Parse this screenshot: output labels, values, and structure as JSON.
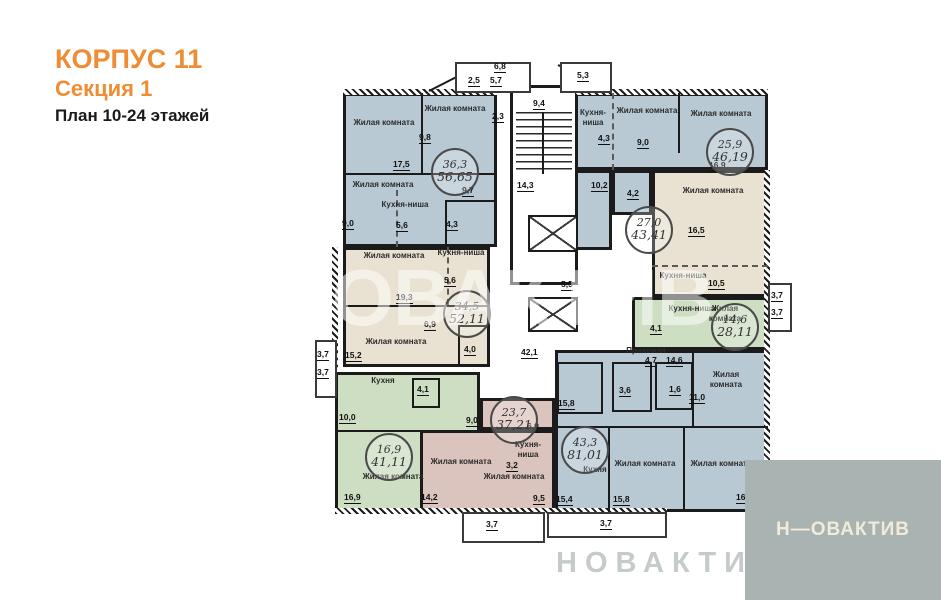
{
  "header": {
    "building": "КОРПУС 11",
    "section": "Секция 1",
    "plan": "План 10-24 этажей"
  },
  "watermark": {
    "main": "НОВАКТИВ",
    "bottom": "НОВАКТИВ"
  },
  "logo": {
    "text": "Н—ОВАКТИВ"
  },
  "colors": {
    "accent": "#ee8d33",
    "apartment_blue": "#b9c9d3",
    "apartment_beige": "#e9e2d2",
    "apartment_green": "#cddec3",
    "apartment_pink": "#dcc4be",
    "wall": "#1b1b1b",
    "logo_bg": "#a9b3b1"
  },
  "core": {
    "stairs_width": "9,4",
    "stairs_depth": "14,3",
    "lift_gap": "5,5",
    "corridor_area": "42,1"
  },
  "edges": {
    "top": [
      "6,8",
      "2,5",
      "5,7",
      "5,3"
    ],
    "left": [
      "3,7",
      "3,7"
    ],
    "right": [
      "3,7",
      "3,7"
    ],
    "bottom": [
      "3,7",
      "3,7"
    ]
  },
  "apartments": [
    {
      "living": "36,3",
      "total": "56,65",
      "rooms": [
        {
          "label": "Жилая комната",
          "area": "17,5"
        },
        {
          "label": "Жилая комната",
          "area": "9,8"
        },
        {
          "label": "Жилая комната",
          "area": "9,0"
        },
        {
          "label": "Кухня-ниша",
          "area": "5,6"
        }
      ],
      "dims": {
        "bath": "4,3",
        "hall": "9,7",
        "edge": "2,3"
      }
    },
    {
      "living": "34,5",
      "total": "52,11",
      "rooms": [
        {
          "label": "Жилая комната",
          "area": "19,3"
        },
        {
          "label": "Кухня-ниша",
          "area": "5,6"
        },
        {
          "label": "Жилая комната",
          "area": "15,2"
        }
      ],
      "dims": {
        "hall": "6,9",
        "bath": "4,0"
      }
    },
    {
      "living": "16,9",
      "total": "41,11",
      "rooms": [
        {
          "label": "Кухня",
          "area": "10,0"
        },
        {
          "label": "Жилая комната",
          "area": "16,9"
        }
      ],
      "dims": {
        "bath": "4,1",
        "hall": "9,0"
      }
    },
    {
      "living": "23,7",
      "total": "37,21",
      "rooms": [
        {
          "label": "Жилая комната",
          "area": "14,2"
        },
        {
          "label": "Жилая комната",
          "area": "9,5"
        },
        {
          "label": "Кухня-ниша",
          "area": "3,2"
        }
      ],
      "dims": {
        "top": "6,0"
      }
    },
    {
      "living": "43,3",
      "total": "81,01",
      "rooms": [
        {
          "label": "Кухня",
          "area": "15,4"
        },
        {
          "label": "Жилая комната",
          "area": "15,8"
        },
        {
          "label": "Жилая комната",
          "area": "16,5"
        },
        {
          "label": "Жилая комната",
          "area": "11,0"
        },
        {
          "label": "Прихожая",
          "area": "4,7"
        }
      ],
      "dims": {
        "entry": "15,8",
        "hall": "14,6",
        "bath": "3,6",
        "wc": "1,6"
      }
    },
    {
      "living": "14,6",
      "total": "28,11",
      "rooms": [
        {
          "label": "Кухня-ниша",
          "area": "4,1"
        },
        {
          "label": "Жилая комната"
        }
      ],
      "dims": {}
    },
    {
      "living": "27,0",
      "total": "43,41",
      "rooms": [
        {
          "label": "Жилая комната",
          "area": "16,5"
        },
        {
          "label": "Кухня-ниша",
          "area": "10,5"
        }
      ],
      "dims": {}
    },
    {
      "living": "25,9",
      "total": "46,19",
      "rooms": [
        {
          "label": "Жилая комната",
          "area": "9,0"
        },
        {
          "label": "Жилая комната",
          "area": "16,9"
        },
        {
          "label": "Кухня-ниша",
          "area": "4,3"
        }
      ],
      "dims": {
        "hall": "10,2",
        "bath": "4,2"
      }
    }
  ]
}
